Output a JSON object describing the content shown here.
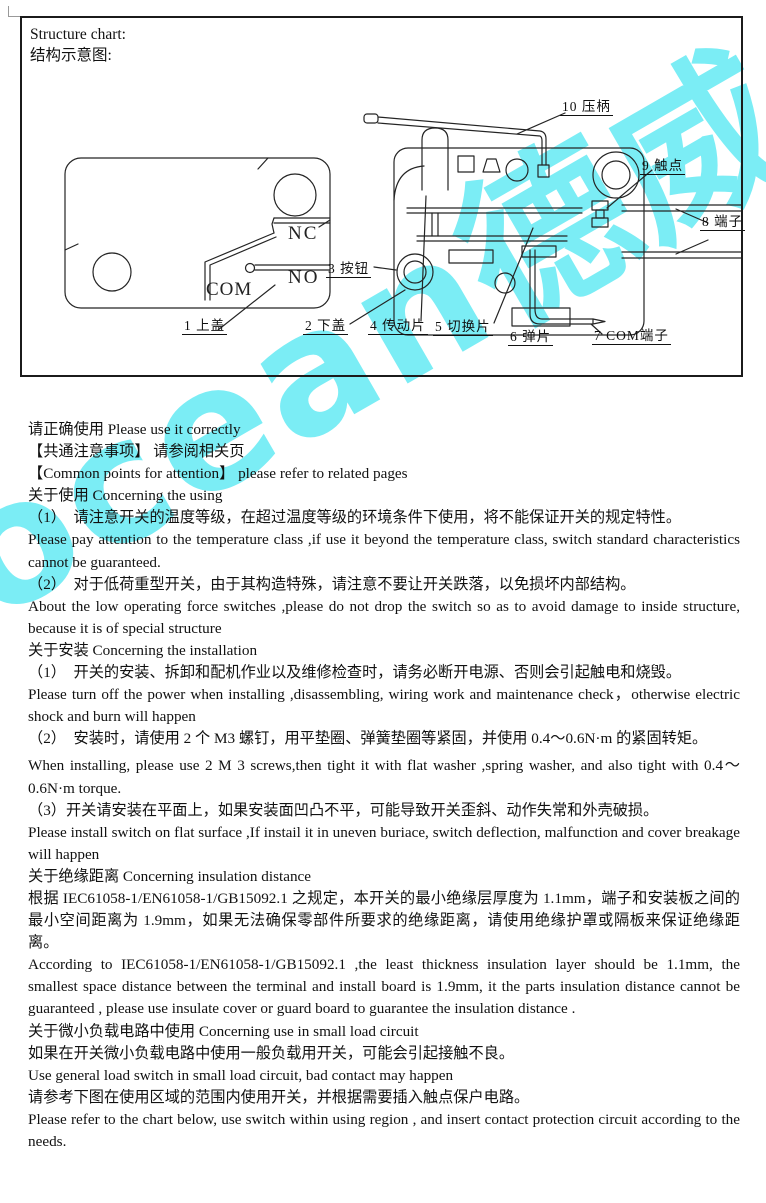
{
  "page": {
    "watermark_text": "ocean德威",
    "watermark_color": "#7BEDF5"
  },
  "structure_chart": {
    "title_en": "Structure chart:",
    "title_cn": "结构示意图:",
    "switch_markings": {
      "nc": "NC",
      "no": "NO",
      "com": "COM"
    },
    "parts": [
      {
        "text": "1 上盖"
      },
      {
        "text": "2 下盖"
      },
      {
        "text": "3 按钮"
      },
      {
        "text": "4 传动片"
      },
      {
        "text": "5 切换片"
      },
      {
        "text": "6 弹片"
      },
      {
        "text": "7 COM端子"
      },
      {
        "text": "8 端子"
      },
      {
        "text": "9 触点"
      },
      {
        "text": "10 压柄"
      }
    ]
  },
  "content": {
    "paragraphs": [
      {
        "text": "请正确使用 Please use it correctly"
      },
      {
        "text": "【共通注意事项】 请参阅相关页"
      },
      {
        "text": "【Common points for attention】 please refer to related pages"
      },
      {
        "text": "关于使用 Concerning the using"
      },
      {
        "text": "（1）　请注意开关的温度等级，在超过温度等级的环境条件下使用，将不能保证开关的规定特性。"
      },
      {
        "text": "Please pay attention to the temperature class ,if use it beyond the temperature class, switch standard characteristics cannot be guaranteed."
      },
      {
        "text": "（2）　对于低荷重型开关，由于其构造特殊，请注意不要让开关跌落，以免损坏内部结构。"
      },
      {
        "text": "About the low operating force switches ,please do not drop the switch so as to avoid damage to inside structure, because it is of special structure"
      },
      {
        "text": "关于安装 Concerning the installation"
      },
      {
        "text": "（1）　开关的安装、拆卸和配机作业以及维修检查时，请务必断开电源、否则会引起触电和烧毁。"
      },
      {
        "text": "Please turn off the power when installing ,disassembling, wiring work and maintenance check，otherwise electric shock and burn will happen"
      },
      {
        "text": "（2）　安装时，请使用 2 个 M3 螺钉，用平垫圈、弹簧垫圈等紧固，并使用 0.4～0.6N·m 的紧固转矩。"
      },
      {
        "text": "When installing, please use 2 M 3 screws,then tight it with flat washer ,spring washer, and also tight with 0.4～0.6N·m torque."
      },
      {
        "text": "（3）开关请安装在平面上，如果安装面凹凸不平，可能导致开关歪斜、动作失常和外壳破损。"
      },
      {
        "text": "Please install switch on flat surface ,If instail it in uneven buriace, switch deflection, malfunction and cover breakage will happen"
      },
      {
        "text": "关于绝缘距离  Concerning insulation distance"
      },
      {
        "text": "根据 IEC61058-1/EN61058-1/GB15092.1 之规定，本开关的最小绝缘层厚度为 1.1mm，端子和安装板之间的最小空间距离为 1.9mm，如果无法确保零部件所要求的绝缘距离，请使用绝缘护罩或隔板来保证绝缘距离。"
      },
      {
        "text": "According to IEC61058-1/EN61058-1/GB15092.1 ,the least thickness insulation layer should be 1.1mm, the smallest space distance between the terminal and install board is 1.9mm, it the parts insulation distance cannot be guaranteed , please use insulate cover or guard board to guarantee the insulation distance ."
      },
      {
        "text": "关于微小负载电路中使用 Concerning use in small load circuit"
      },
      {
        "text": "如果在开关微小负载电路中使用一般负载用开关，可能会引起接触不良。"
      },
      {
        "text": "Use general load switch in small load circuit, bad contact may happen"
      },
      {
        "text": "请参考下图在使用区域的范围内使用开关，并根据需要插入触点保户电路。"
      },
      {
        "text": "Please refer to the chart below, use switch within using region , and insert contact protection circuit according to the needs."
      }
    ]
  }
}
